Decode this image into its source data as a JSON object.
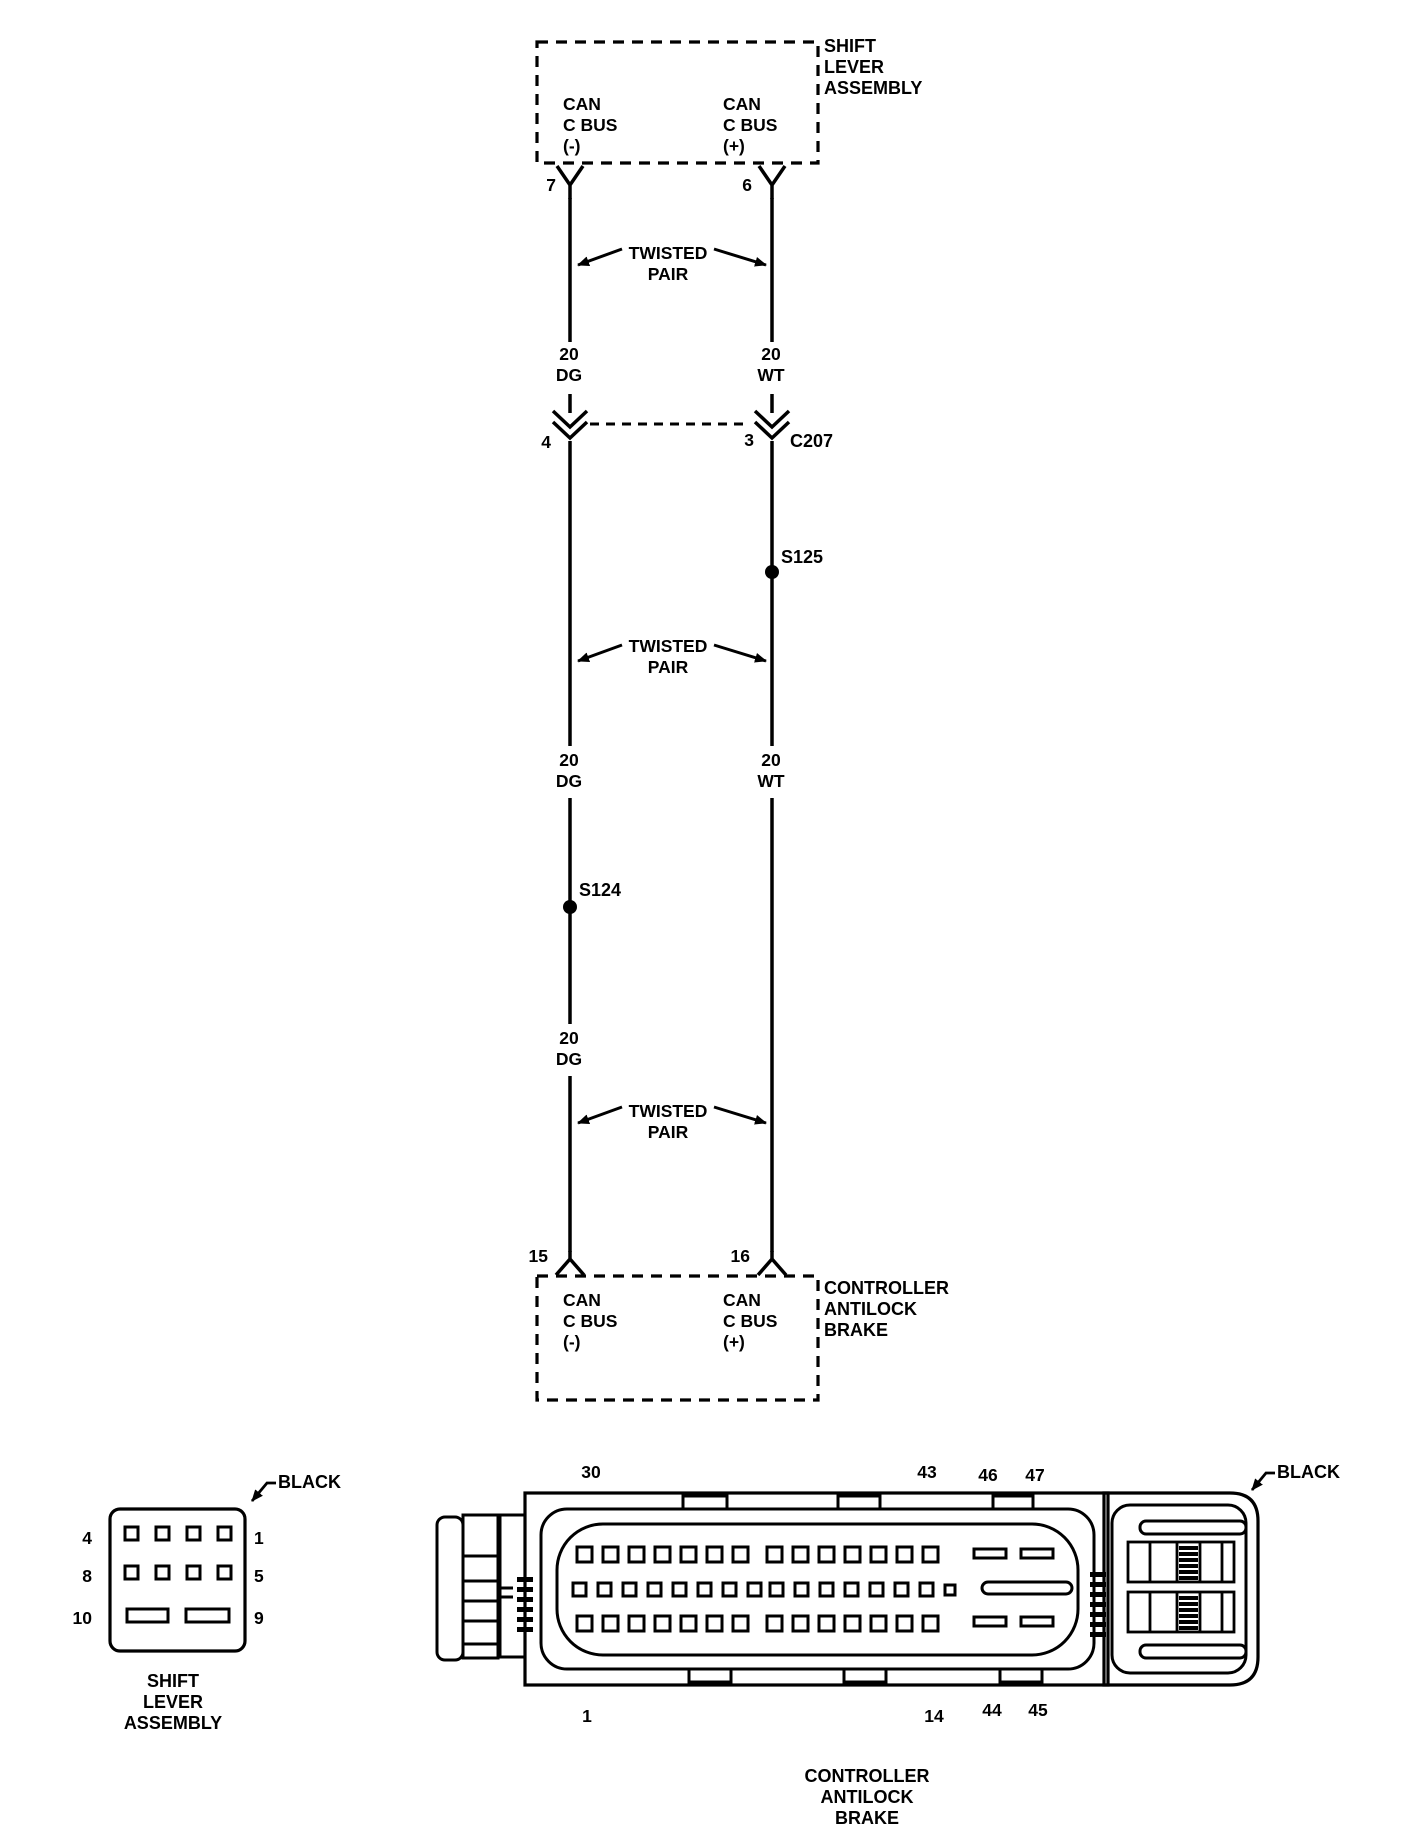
{
  "schematic": {
    "top_component": {
      "name": "SHIFT\nLEVER\nASSEMBLY",
      "pin_left": "7",
      "pin_right": "6",
      "signal_left": "CAN\nC BUS\n(-)",
      "signal_right": "CAN\nC BUS\n(+)"
    },
    "bottom_component": {
      "name": "CONTROLLER\nANTILOCK\nBRAKE",
      "pin_left": "15",
      "pin_right": "16",
      "signal_left": "CAN\nC BUS\n(-)",
      "signal_right": "CAN\nC BUS\n(+)"
    },
    "inline_connector": {
      "name": "C207",
      "pin_left": "4",
      "pin_right": "3"
    },
    "splice_left": "S124",
    "splice_right": "S125",
    "twisted_pair": "TWISTED\nPAIR",
    "wire_left_label": "20\nDG",
    "wire_right_label": "20\nWT"
  },
  "sla_connector": {
    "color": "BLACK",
    "caption": "SHIFT\nLEVER\nASSEMBLY",
    "pin_row1_left": "4",
    "pin_row1_right": "1",
    "pin_row2_left": "8",
    "pin_row2_right": "5",
    "pin_row3_left": "10",
    "pin_row3_right": "9"
  },
  "cab_connector": {
    "color": "BLACK",
    "caption": "CONTROLLER\nANTILOCK\nBRAKE",
    "pin_top_left": "30",
    "pin_top_right": "43",
    "pin_top_bar1": "46",
    "pin_top_bar2": "47",
    "pin_bottom_left": "1",
    "pin_bottom_right": "14",
    "pin_bottom_bar1": "44",
    "pin_bottom_bar2": "45"
  },
  "colors": {
    "ink": "#000000",
    "paper": "#ffffff"
  }
}
